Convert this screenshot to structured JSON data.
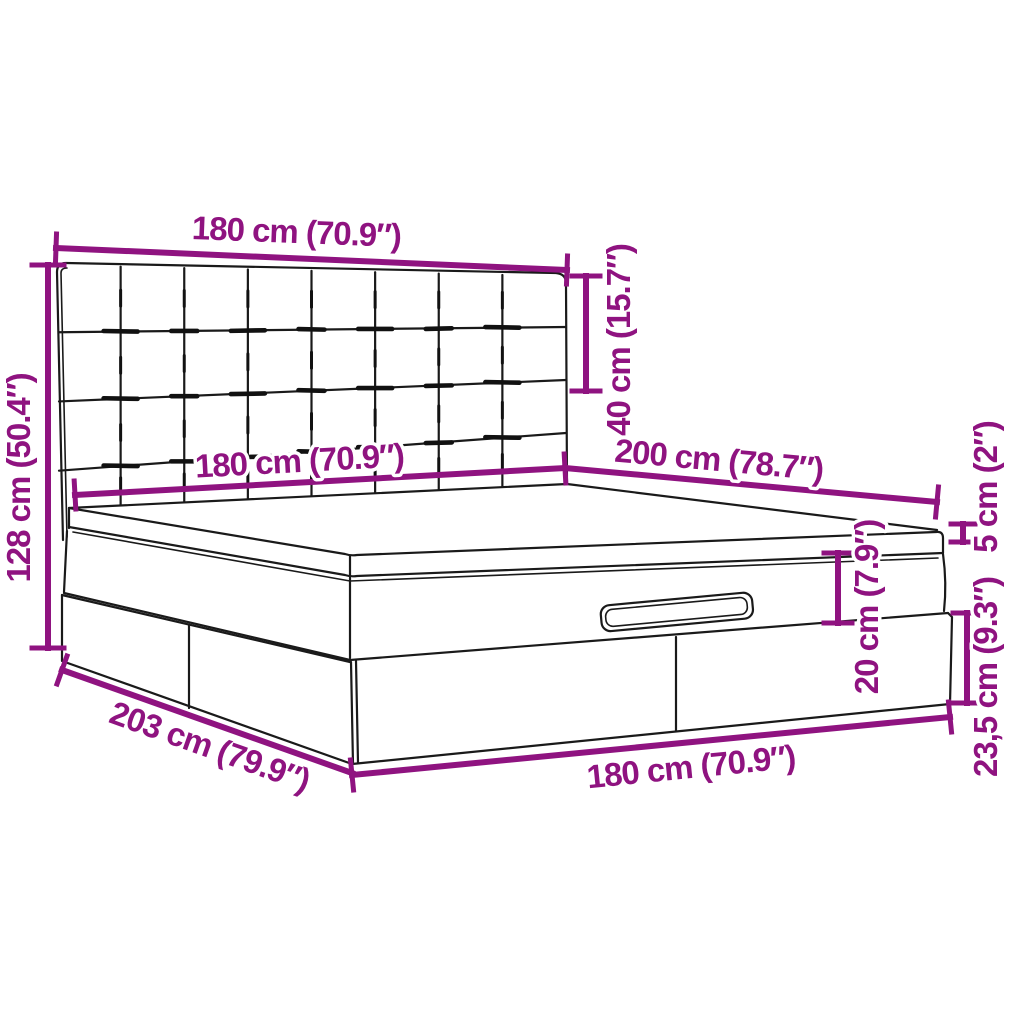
{
  "diagram": {
    "type": "product-dimension-diagram",
    "product": "ottoman-storage-bed-with-tufted-headboard",
    "background": "#FFFFFF",
    "accent_color": "#8F1380",
    "line_color": "#1A1A1A",
    "dimensions": {
      "headboard_width": {
        "cm": "180",
        "inches": "70.9",
        "label": "180 cm (70.9″)"
      },
      "headboard_height": {
        "cm": "40",
        "inches": "15.7",
        "label": "40 cm (15.7″)"
      },
      "total_height": {
        "cm": "128",
        "inches": "50.4",
        "label": "128 cm (50.4″)"
      },
      "mattress_width": {
        "cm": "180",
        "inches": "70.9",
        "label": "180 cm (70.9″)"
      },
      "mattress_length": {
        "cm": "200",
        "inches": "78.7",
        "label": "200 cm (78.7″)"
      },
      "topper_thickness": {
        "cm": "5",
        "inches": "2",
        "label": "5 cm (2″)"
      },
      "upper_frame_height": {
        "cm": "20",
        "inches": "7.9",
        "label": "20 cm (7.9″)"
      },
      "storage_base_height": {
        "cm": "23,5",
        "inches": "9.3",
        "label": "23,5 cm (9.3″)"
      },
      "base_width": {
        "cm": "180",
        "inches": "70.9",
        "label": "180 cm (70.9″)"
      },
      "total_length": {
        "cm": "203",
        "inches": "79.9",
        "label": "203 cm (79.9″)"
      }
    }
  }
}
